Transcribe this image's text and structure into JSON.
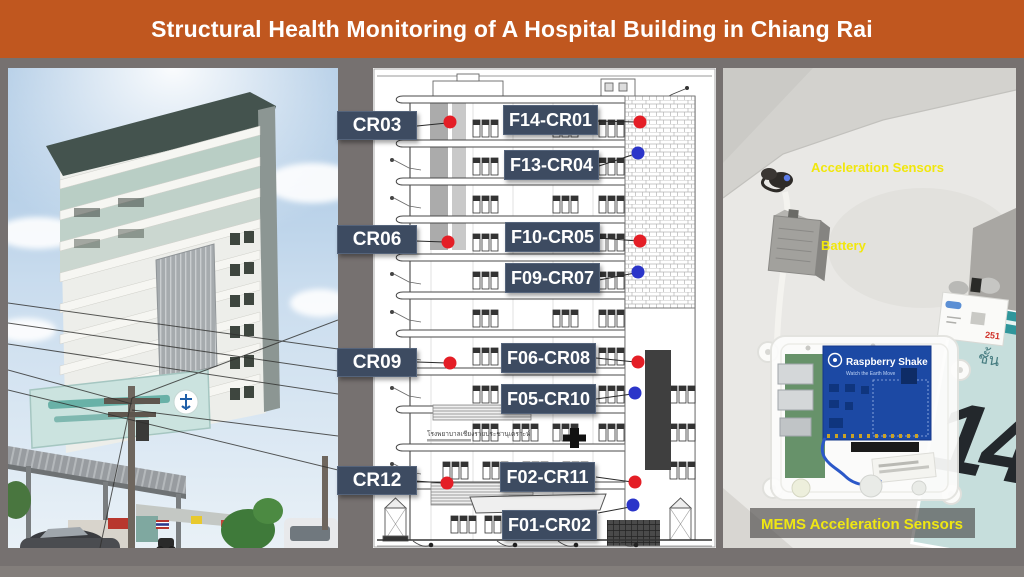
{
  "header": {
    "title": "Structural Health Monitoring of A Hospital Building in Chiang Rai"
  },
  "colors": {
    "header_bg": "#C0571F",
    "slide_bg": "#767170",
    "sensor_label_bg": "#3D4B61",
    "sensor_label_text": "#FFFFFF",
    "red_dot": "#E41E26",
    "blue_dot": "#2B35C9",
    "annotation_yellow": "#F1E70C"
  },
  "elevation": {
    "left_labels": [
      "CR03",
      "CR06",
      "CR09",
      "CR12"
    ],
    "floor_labels": [
      "F14-CR01",
      "F13-CR04",
      "F10-CR05",
      "F09-CR07",
      "F06-CR08",
      "F05-CR10",
      "F02-CR11",
      "F01-CR02"
    ],
    "caption_thai": "โรงพยาบาลเชียงรายประชานุเคราะห์"
  },
  "right_photo": {
    "annotations": {
      "acceleration_sensors": "Acceleration Sensors",
      "battery": "Battery",
      "mems": "MEMS Acceleration Sensors"
    },
    "device": {
      "brand": "Raspberry Shake",
      "tagline": "Watch the Earth Move"
    },
    "floor_sign": {
      "floor_word": "ชั้น",
      "floor_number": "14"
    },
    "meter_label": "251"
  }
}
